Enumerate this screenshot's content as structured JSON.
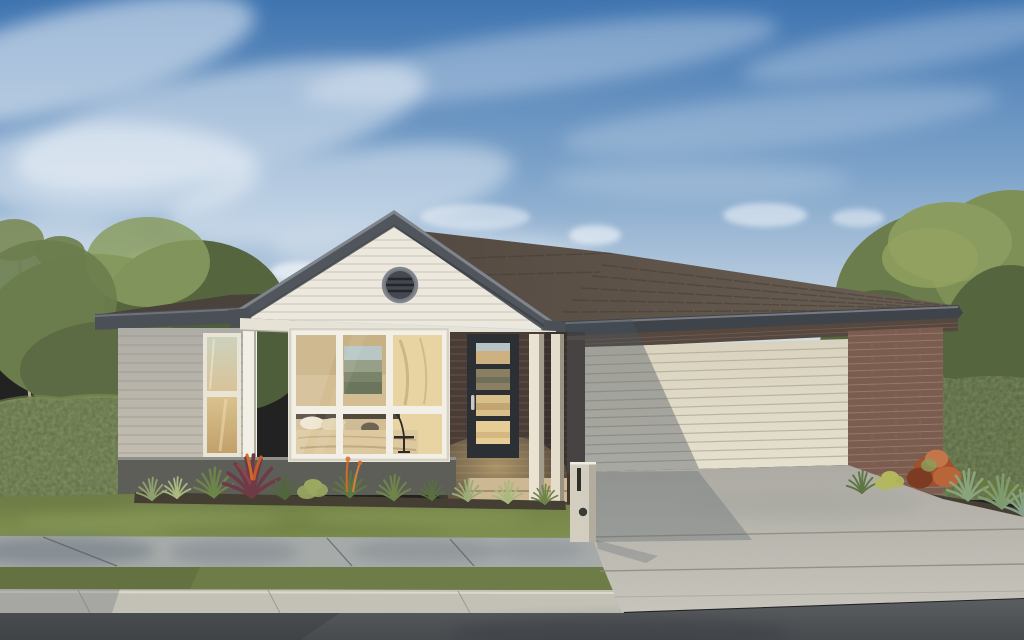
{
  "image": {
    "width": 1024,
    "height": 640,
    "kind": "photoreal architectural render, front elevation of a single-storey house on a street"
  },
  "colors": {
    "sky_top": "#3f74b0",
    "sky_mid": "#7fa4ca",
    "sky_horizon": "#d7e1ea",
    "cloud": "#ffffff",
    "tree_dark": "#55653e",
    "tree_mid": "#6b7d4c",
    "tree_light": "#8a9c60",
    "hedge": "#5d6c43",
    "hedge_light": "#798850",
    "roof_main": "#5f544a",
    "roof_row": "#463d34",
    "roof_wing_dark": "#4a433c",
    "fascia": "#565b61",
    "fascia_dark": "#3f444a",
    "fascia_light": "#858a90",
    "gable_siding": "#ece8dd",
    "siding_gray": "#b7b4ac",
    "trim_white": "#f2efe6",
    "glass_warm": "#d6bd92",
    "brick_dark": "#4a3d36",
    "brick_red": "#7b5c4e",
    "door_charcoal": "#2c2f33",
    "garage_door": "#e0dac8",
    "garage_slat": "#b4ad99",
    "shadow_blue": "#4b5560",
    "post_cream": "#eae3d2",
    "post_shade": "#a49d8e",
    "base_wall": "#5e5e58",
    "soil": "#453e32",
    "lawn": "#7a8a50",
    "driveway": "#b9b7af",
    "footpath": "#a6aaa9",
    "curb": "#c3c1b6",
    "road": "#54575b",
    "letterbox": "#d8d3c4",
    "plant_red": "#6e3a45",
    "plant_orange": "#cf6a2d"
  },
  "house": {
    "storeys": 1,
    "garage_door_panel_lines": 13,
    "front_door_glass_panels": 4,
    "bedroom_window_panes": 6,
    "side_window_panes": 2,
    "porch_posts": 2,
    "gable_vent": "round louvred vent"
  },
  "landscape": {
    "elements": [
      "blue sky with wispy clouds",
      "gum trees on left",
      "large tree on right",
      "clipped hedge left boundary",
      "clipped hedge right boundary",
      "front lawn",
      "garden bed with grasses, burgundy cordyline and orange accents",
      "garden bed with rust shrub and agaves by driveway",
      "concrete letterbox pillar",
      "concrete driveway to double garage",
      "concrete footpath",
      "grass nature strip",
      "concrete kerb",
      "asphalt road"
    ]
  }
}
